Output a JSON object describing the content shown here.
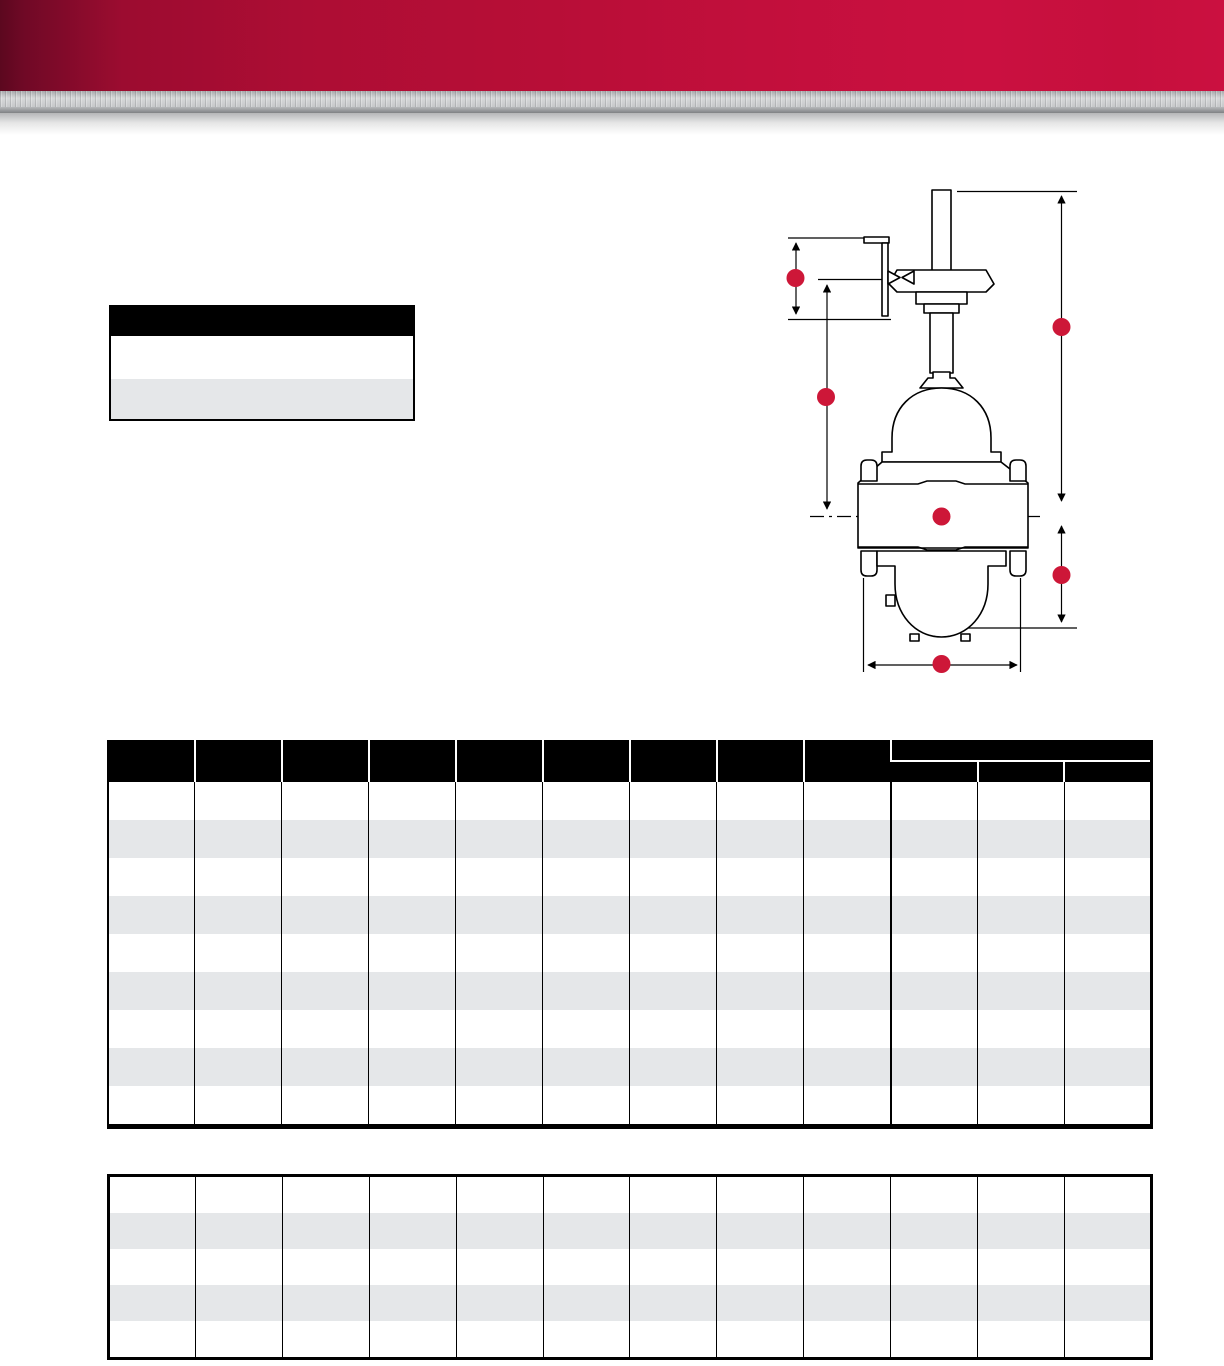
{
  "page": {
    "width": 1224,
    "height": 1366,
    "description": "Product catalog dimensions page: crimson banner with brushed-metal strip, blank legend key box, valve cross-section diagram with six red dimension-callout dots, and two blank zebra-striped dimension tables"
  },
  "theme": {
    "accent_red": "#cd1738",
    "banner_dark_red": "#5c081f",
    "banner_bright_red": "#cb1040",
    "metal_light_gray": "#d7d8d9",
    "metal_dark_gray": "#7f8184",
    "row_stripe_gray": "#e5e7e9",
    "header_black": "#000000",
    "page_white": "#ffffff"
  },
  "banner": {
    "title_text": ""
  },
  "legend_box": {
    "header_label": "",
    "rows": [
      {
        "label": ""
      },
      {
        "label": ""
      }
    ]
  },
  "diagram": {
    "type": "valve-cross-section-with-dimension-lines",
    "callout_color": "#cd1738",
    "callout_radius": 9,
    "callouts": [
      {
        "label": "",
        "x": 795.5,
        "y": 278
      },
      {
        "label": "",
        "x": 826,
        "y": 397
      },
      {
        "label": "",
        "x": 1061.5,
        "y": 327
      },
      {
        "label": "",
        "x": 941.5,
        "y": 516.5
      },
      {
        "label": "",
        "x": 1061.5,
        "y": 575
      },
      {
        "label": "",
        "x": 941.5,
        "y": 664
      }
    ]
  },
  "dimensions_table": {
    "column_count": 12,
    "row_count": 9,
    "group_divider_col": 9,
    "header": {
      "plain_columns": [
        "",
        "",
        "",
        "",
        "",
        "",
        "",
        "",
        ""
      ],
      "group": {
        "label": "",
        "subcolumns": [
          "",
          "",
          ""
        ]
      }
    },
    "rows": []
  },
  "secondary_table": {
    "column_count": 12,
    "row_count": 5,
    "rows": []
  }
}
